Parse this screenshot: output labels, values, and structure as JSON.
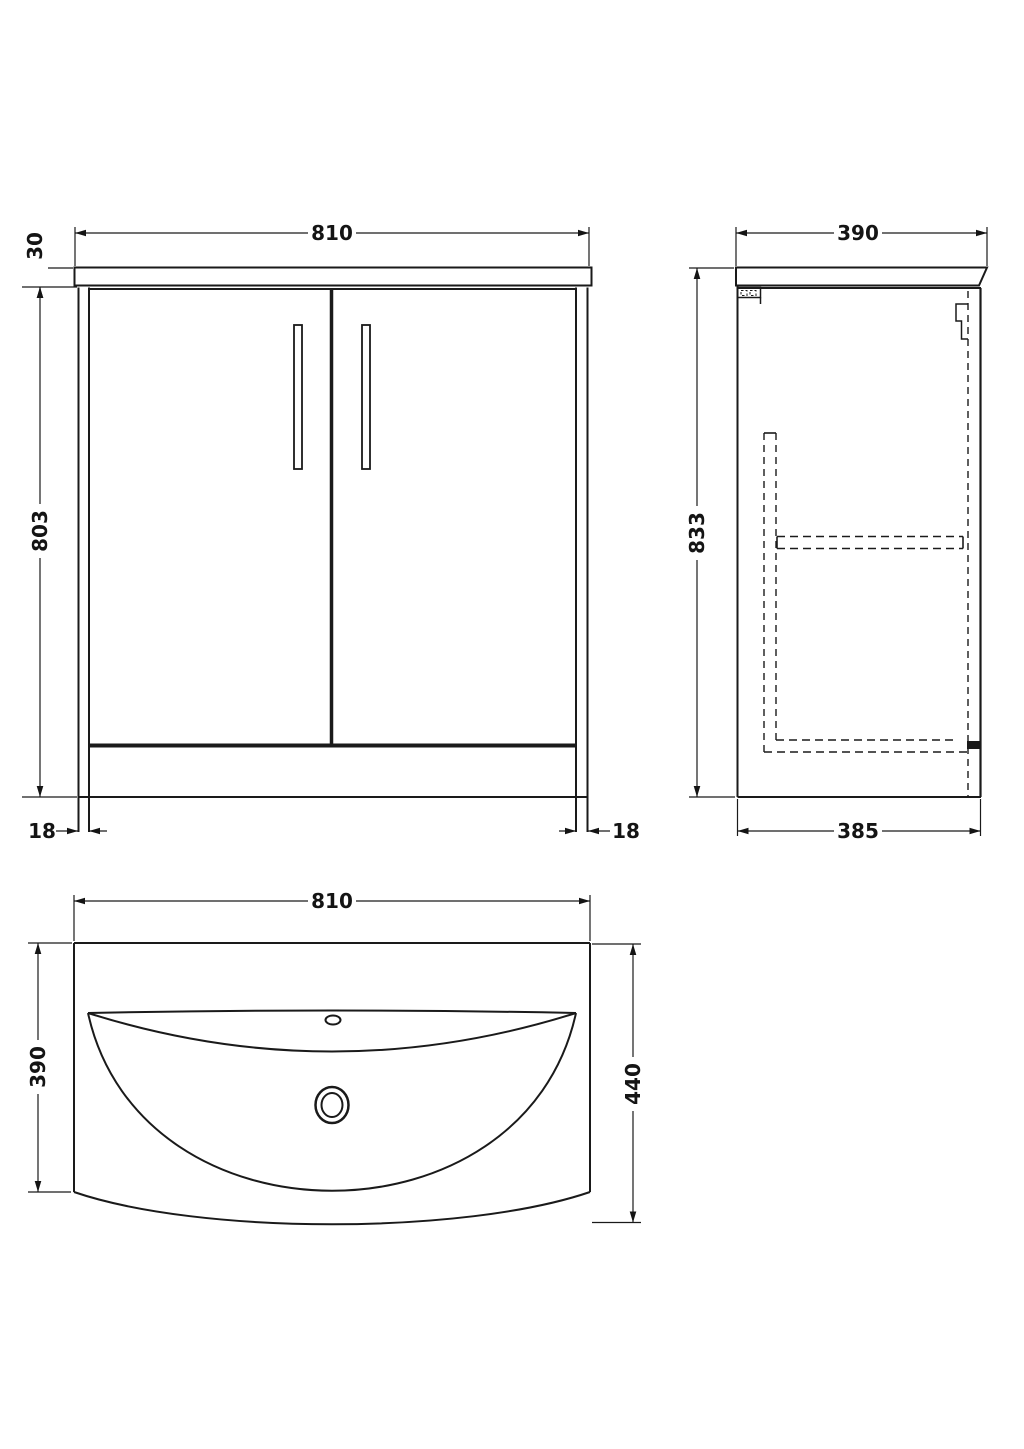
{
  "drawing": {
    "title": "vanity unit dimension drawing",
    "line_color": "#1a1a1a",
    "background": "#ffffff",
    "views": {
      "front": {
        "label": "front elevation",
        "dims": {
          "width": "810",
          "worktop_height": "30",
          "body_height": "803",
          "left_leg_thickness": "18",
          "right_leg_thickness": "18"
        }
      },
      "side": {
        "label": "side elevation",
        "dims": {
          "depth": "390",
          "height": "833",
          "base_depth": "385"
        }
      },
      "basin": {
        "label": "basin plan view",
        "dims": {
          "width": "810",
          "depth": "390",
          "overall_depth": "440"
        }
      }
    }
  }
}
